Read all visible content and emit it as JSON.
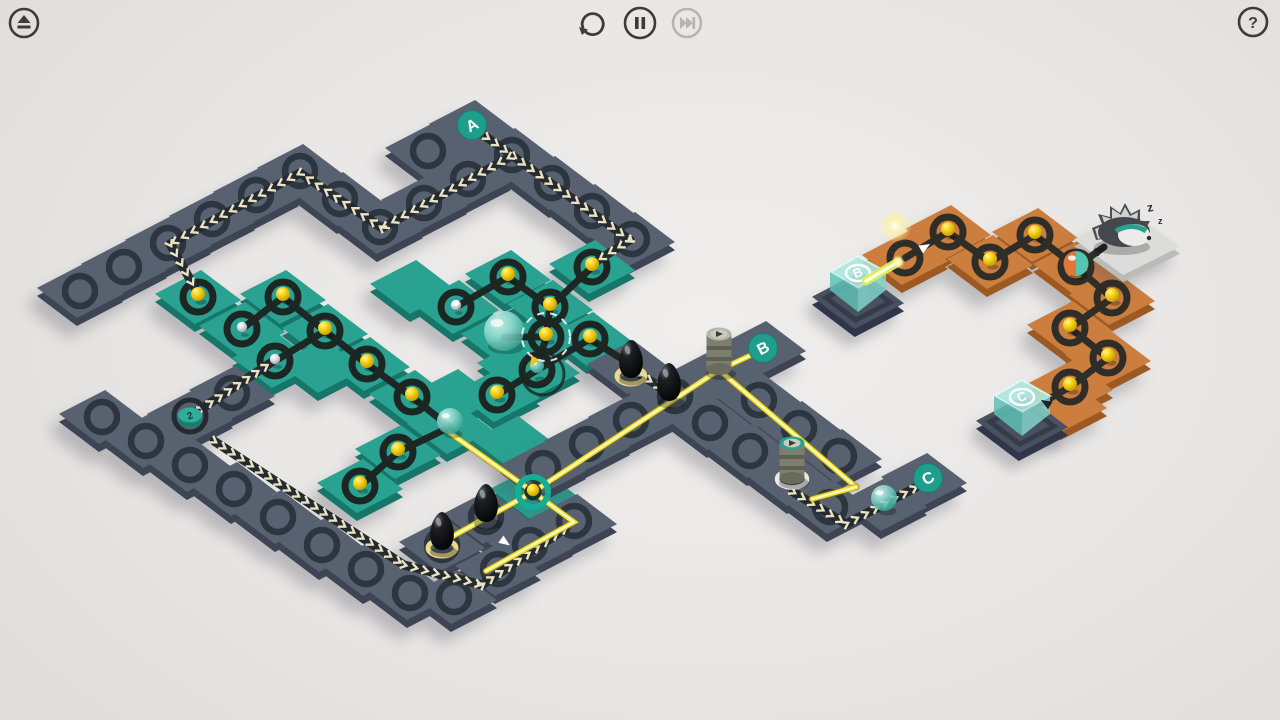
{
  "topbar": {
    "eject_label": "eject",
    "undo_label": "undo",
    "pause_label": "pause",
    "skip_label": "skip",
    "help_label": "?",
    "icon_color": "#3c3c3c",
    "disabled_color": "#b7b4b0"
  },
  "colors": {
    "slate": "#57616f",
    "slate_side": "#3d4453",
    "slate_ring": "#2d3540",
    "teal": "#2aa291",
    "teal_side": "#16766a",
    "teal_ring": "#1c2622",
    "orange": "#cb7e3e",
    "orange_side": "#9c5a22",
    "orange_ring": "#2e2d28",
    "base": "#49505f",
    "base_side": "#30364a",
    "platform": "#dcdcda",
    "platform_side": "#bbbbb8",
    "chevron": "#eae3c2",
    "chevron_stripe": "#252a31",
    "wire": "#f2e43c",
    "wire_core": "#fffbd9",
    "ball_yellow": "#ffd91e",
    "ball_silver": "#e8e8ea",
    "glass": "#7fd4c9",
    "badge": "#1f9e8d",
    "badge_text": "#ffffff",
    "beam": "#d9f05a"
  },
  "boards": [
    {
      "name": "frame",
      "color": "slate",
      "tiles": [
        [
          472,
          127
        ],
        [
          428,
          151
        ],
        [
          512,
          155
        ],
        [
          552,
          183
        ],
        [
          592,
          211
        ],
        [
          632,
          239
        ],
        [
          468,
          179
        ],
        [
          424,
          203
        ],
        [
          380,
          227
        ],
        [
          340,
          199
        ],
        [
          300,
          171
        ],
        [
          256,
          195
        ],
        [
          212,
          219
        ],
        [
          168,
          243
        ],
        [
          124,
          267
        ],
        [
          80,
          291
        ]
      ]
    },
    {
      "name": "teal-network",
      "color": "teal",
      "tiles": [
        [
          592,
          267
        ],
        [
          508,
          277
        ],
        [
          550,
          307
        ],
        [
          456,
          307
        ],
        [
          504,
          337
        ],
        [
          546,
          337
        ],
        [
          590,
          339
        ],
        [
          412,
          397
        ],
        [
          497,
          395
        ],
        [
          198,
          297
        ],
        [
          283,
          297
        ],
        [
          242,
          329
        ],
        [
          325,
          331
        ],
        [
          367,
          364
        ],
        [
          275,
          361
        ],
        [
          450,
          427
        ],
        [
          398,
          452
        ],
        [
          360,
          486
        ],
        [
          533,
          492
        ],
        [
          455,
          396
        ],
        [
          515,
          443
        ],
        [
          520,
          366
        ],
        [
          413,
          287
        ],
        [
          321,
          366
        ],
        [
          537,
          370
        ]
      ]
    },
    {
      "name": "cross-arms",
      "color": "slate",
      "tiles": [
        [
          630,
          367
        ],
        [
          670,
          395
        ],
        [
          710,
          423
        ],
        [
          750,
          451
        ],
        [
          719,
          372
        ],
        [
          763,
          348
        ],
        [
          675,
          396
        ],
        [
          631,
          420
        ],
        [
          587,
          444
        ],
        [
          543,
          468
        ],
        [
          759,
          400
        ],
        [
          799,
          428
        ],
        [
          839,
          456
        ],
        [
          790,
          479
        ],
        [
          830,
          507
        ],
        [
          884,
          504
        ],
        [
          924,
          480
        ]
      ]
    },
    {
      "name": "bottom-left",
      "color": "slate",
      "tiles": [
        [
          102,
          417
        ],
        [
          146,
          441
        ],
        [
          190,
          417
        ],
        [
          232,
          393
        ],
        [
          190,
          465
        ],
        [
          234,
          489
        ],
        [
          278,
          517
        ],
        [
          322,
          545
        ],
        [
          366,
          569
        ],
        [
          410,
          593
        ],
        [
          442,
          545
        ],
        [
          486,
          517
        ],
        [
          454,
          597
        ],
        [
          498,
          569
        ],
        [
          530,
          545
        ],
        [
          574,
          521
        ]
      ]
    },
    {
      "name": "orange-path",
      "color": "orange",
      "tiles": [
        [
          905,
          258
        ],
        [
          948,
          232
        ],
        [
          990,
          262
        ],
        [
          1035,
          235
        ],
        [
          1076,
          267
        ],
        [
          1112,
          298
        ],
        [
          1070,
          328
        ],
        [
          1108,
          358
        ],
        [
          1070,
          387
        ],
        [
          1064,
          405
        ]
      ]
    }
  ],
  "cube_bases": [
    [
      858,
      300
    ],
    [
      1022,
      424
    ]
  ],
  "platform": {
    "x": 1127,
    "y": 243
  },
  "rings_empty": {
    "frame": [
      [
        428,
        151
      ],
      [
        512,
        155
      ],
      [
        552,
        183
      ],
      [
        592,
        211
      ],
      [
        632,
        239
      ],
      [
        468,
        179
      ],
      [
        424,
        203
      ],
      [
        380,
        227
      ],
      [
        340,
        199
      ],
      [
        300,
        171
      ],
      [
        256,
        195
      ],
      [
        212,
        219
      ],
      [
        168,
        243
      ],
      [
        124,
        267
      ],
      [
        80,
        291
      ]
    ],
    "cross": [
      [
        710,
        423
      ],
      [
        750,
        451
      ],
      [
        675,
        396
      ],
      [
        631,
        420
      ],
      [
        587,
        444
      ],
      [
        543,
        468
      ],
      [
        759,
        400
      ],
      [
        799,
        428
      ],
      [
        839,
        456
      ],
      [
        830,
        507
      ]
    ],
    "bottom": [
      [
        102,
        417
      ],
      [
        146,
        441
      ],
      [
        232,
        393
      ],
      [
        190,
        465
      ],
      [
        234,
        489
      ],
      [
        278,
        517
      ],
      [
        322,
        545
      ],
      [
        366,
        569
      ],
      [
        410,
        593
      ],
      [
        454,
        597
      ],
      [
        498,
        569
      ],
      [
        530,
        545
      ],
      [
        574,
        521
      ],
      [
        486,
        517
      ],
      [
        442,
        545
      ]
    ]
  },
  "nodes": [
    {
      "x": 592,
      "y": 267,
      "board": "teal",
      "ball": "yellow"
    },
    {
      "x": 508,
      "y": 277,
      "board": "teal",
      "ball": "yellow"
    },
    {
      "x": 550,
      "y": 307,
      "board": "teal",
      "ball": "yellow"
    },
    {
      "x": 456,
      "y": 307,
      "board": "teal",
      "ball": "silver"
    },
    {
      "x": 546,
      "y": 337,
      "board": "teal",
      "ball": "yellow",
      "highlight": true
    },
    {
      "x": 590,
      "y": 339,
      "board": "teal",
      "ball": "yellow"
    },
    {
      "x": 412,
      "y": 397,
      "board": "teal",
      "ball": "yellow"
    },
    {
      "x": 497,
      "y": 395,
      "board": "teal",
      "ball": "yellow"
    },
    {
      "x": 198,
      "y": 297,
      "board": "teal",
      "ball": "yellow"
    },
    {
      "x": 283,
      "y": 297,
      "board": "teal",
      "ball": "yellow"
    },
    {
      "x": 242,
      "y": 329,
      "board": "teal",
      "ball": "silver"
    },
    {
      "x": 325,
      "y": 331,
      "board": "teal",
      "ball": "yellow"
    },
    {
      "x": 367,
      "y": 364,
      "board": "teal",
      "ball": "yellow"
    },
    {
      "x": 275,
      "y": 361,
      "board": "teal",
      "ball": "silver"
    },
    {
      "x": 398,
      "y": 452,
      "board": "teal",
      "ball": "yellow"
    },
    {
      "x": 360,
      "y": 486,
      "board": "teal",
      "ball": "yellow"
    },
    {
      "x": 537,
      "y": 370,
      "board": "teal",
      "ball": "mini-glass",
      "ripple": true
    },
    {
      "x": 948,
      "y": 232,
      "board": "orange",
      "ball": "yellow"
    },
    {
      "x": 990,
      "y": 262,
      "board": "orange",
      "ball": "yellow"
    },
    {
      "x": 1035,
      "y": 235,
      "board": "orange",
      "ball": "yellow"
    },
    {
      "x": 1076,
      "y": 267,
      "board": "orange",
      "ball": "split"
    },
    {
      "x": 1112,
      "y": 298,
      "board": "orange",
      "ball": "yellow"
    },
    {
      "x": 1070,
      "y": 328,
      "board": "orange",
      "ball": "yellow"
    },
    {
      "x": 1108,
      "y": 358,
      "board": "orange",
      "ball": "yellow"
    },
    {
      "x": 1070,
      "y": 387,
      "board": "orange",
      "ball": "yellow"
    },
    {
      "x": 905,
      "y": 258,
      "board": "orange",
      "ball": null
    }
  ],
  "glass_balls": [
    [
      450,
      427
    ],
    [
      884,
      504
    ]
  ],
  "dome": {
    "x": 504,
    "y": 331
  },
  "junction": {
    "x": 533,
    "y": 492
  },
  "edges": {
    "teal": [
      [
        [
          508,
          277
        ],
        [
          456,
          307
        ]
      ],
      [
        [
          508,
          277
        ],
        [
          550,
          307
        ]
      ],
      [
        [
          550,
          307
        ],
        [
          592,
          267
        ]
      ],
      [
        [
          550,
          307
        ],
        [
          546,
          337
        ]
      ],
      [
        [
          546,
          337
        ],
        [
          504,
          337
        ]
      ],
      [
        [
          546,
          337
        ],
        [
          537,
          370
        ]
      ],
      [
        [
          537,
          370
        ],
        [
          590,
          339
        ]
      ],
      [
        [
          537,
          370
        ],
        [
          497,
          395
        ]
      ],
      [
        [
          283,
          297
        ],
        [
          242,
          329
        ]
      ],
      [
        [
          283,
          297
        ],
        [
          325,
          331
        ]
      ],
      [
        [
          325,
          331
        ],
        [
          367,
          364
        ]
      ],
      [
        [
          367,
          364
        ],
        [
          412,
          397
        ]
      ],
      [
        [
          412,
          397
        ],
        [
          450,
          427
        ]
      ],
      [
        [
          450,
          427
        ],
        [
          398,
          452
        ]
      ],
      [
        [
          398,
          452
        ],
        [
          360,
          486
        ]
      ],
      [
        [
          325,
          331
        ],
        [
          275,
          361
        ]
      ],
      [
        [
          590,
          339
        ],
        [
          630,
          364
        ]
      ]
    ],
    "orange": [
      [
        [
          905,
          258
        ],
        [
          948,
          232
        ]
      ],
      [
        [
          948,
          232
        ],
        [
          990,
          262
        ]
      ],
      [
        [
          990,
          262
        ],
        [
          1035,
          235
        ]
      ],
      [
        [
          1035,
          235
        ],
        [
          1076,
          267
        ]
      ],
      [
        [
          1076,
          267
        ],
        [
          1112,
          298
        ]
      ],
      [
        [
          1112,
          298
        ],
        [
          1070,
          328
        ]
      ],
      [
        [
          1070,
          328
        ],
        [
          1108,
          358
        ]
      ],
      [
        [
          1108,
          358
        ],
        [
          1070,
          387
        ]
      ],
      [
        [
          1076,
          267
        ],
        [
          1104,
          247
        ]
      ],
      [
        [
          1070,
          387
        ],
        [
          1040,
          404
        ]
      ]
    ]
  },
  "chevron_paths": [
    {
      "name": "path-from-A-to-teal",
      "pts": [
        [
          478,
          131
        ],
        [
          630,
          240
        ],
        [
          592,
          264
        ]
      ]
    },
    {
      "name": "path-frame-zigzag",
      "pts": [
        [
          510,
          157
        ],
        [
          382,
          228
        ],
        [
          300,
          173
        ],
        [
          170,
          244
        ],
        [
          196,
          290
        ]
      ]
    },
    {
      "name": "path-disc-to-teal",
      "pts": [
        [
          192,
          415
        ],
        [
          272,
          362
        ]
      ]
    },
    {
      "name": "path-bottom-band",
      "pts": [
        [
          214,
          441
        ],
        [
          404,
          565
        ],
        [
          482,
          585
        ],
        [
          566,
          528
        ]
      ]
    },
    {
      "name": "path-post2-to-C",
      "pts": [
        [
          793,
          492
        ],
        [
          846,
          524
        ],
        [
          926,
          482
        ]
      ]
    },
    {
      "name": "path-pawn-stub",
      "pts": [
        [
          640,
          374
        ],
        [
          670,
          394
        ]
      ]
    }
  ],
  "wires": [
    {
      "name": "wire-junction-post1",
      "pts": [
        [
          533,
          492
        ],
        [
          719,
          370
        ]
      ]
    },
    {
      "name": "wire-post1-B",
      "pts": [
        [
          719,
          370
        ],
        [
          760,
          351
        ]
      ]
    },
    {
      "name": "wire-post1-long",
      "pts": [
        [
          719,
          370
        ],
        [
          856,
          487
        ]
      ]
    },
    {
      "name": "wire-stub-post2",
      "pts": [
        [
          856,
          487
        ],
        [
          812,
          499
        ]
      ]
    },
    {
      "name": "wire-junction-glassball",
      "pts": [
        [
          533,
          492
        ],
        [
          450,
          433
        ]
      ]
    },
    {
      "name": "wire-junction-pawn",
      "pts": [
        [
          533,
          492
        ],
        [
          444,
          541
        ]
      ]
    },
    {
      "name": "wire-junction-v",
      "pts": [
        [
          533,
          492
        ],
        [
          574,
          522
        ],
        [
          486,
          571
        ]
      ]
    }
  ],
  "beam": {
    "pts": [
      [
        866,
        281
      ],
      [
        898,
        262
      ]
    ]
  },
  "badges": [
    {
      "label": "A",
      "x": 472,
      "y": 125
    },
    {
      "label": "B",
      "x": 763,
      "y": 348
    },
    {
      "label": "C",
      "x": 928,
      "y": 478
    }
  ],
  "counter_disc": {
    "label": "2",
    "x": 190,
    "y": 416
  },
  "pawns": [
    {
      "x": 631,
      "y": 376,
      "ring": "yellow"
    },
    {
      "x": 669,
      "y": 399,
      "ring": null
    },
    {
      "x": 442,
      "y": 548,
      "ring": "yellow"
    },
    {
      "x": 486,
      "y": 520,
      "ring": null
    }
  ],
  "posts": [
    {
      "x": 719,
      "y": 370,
      "style": "plain"
    },
    {
      "x": 792,
      "y": 479,
      "style": "teal"
    }
  ],
  "cubes": [
    {
      "label": "B",
      "x": 858,
      "y": 292
    },
    {
      "label": "C",
      "x": 1022,
      "y": 416
    }
  ],
  "hedgehog": {
    "x": 1122,
    "y": 230,
    "zzz": [
      "z",
      "z"
    ]
  },
  "glow": {
    "x": 895,
    "y": 226
  },
  "markers": [
    {
      "x": 925,
      "y": 247,
      "dir": -30,
      "color": "#ffffff"
    },
    {
      "x": 505,
      "y": 542,
      "dir": 35,
      "color": "#ffffff"
    },
    {
      "x": 1046,
      "y": 403,
      "dir": 210,
      "color": "#20262c"
    },
    {
      "x": 1100,
      "y": 250,
      "dir": -32,
      "color": "#20262c"
    },
    {
      "x": 533,
      "y": 362,
      "dir": 120,
      "color": "#e8c61e"
    }
  ],
  "sparkle": {
    "x": 456,
    "y": 303
  }
}
